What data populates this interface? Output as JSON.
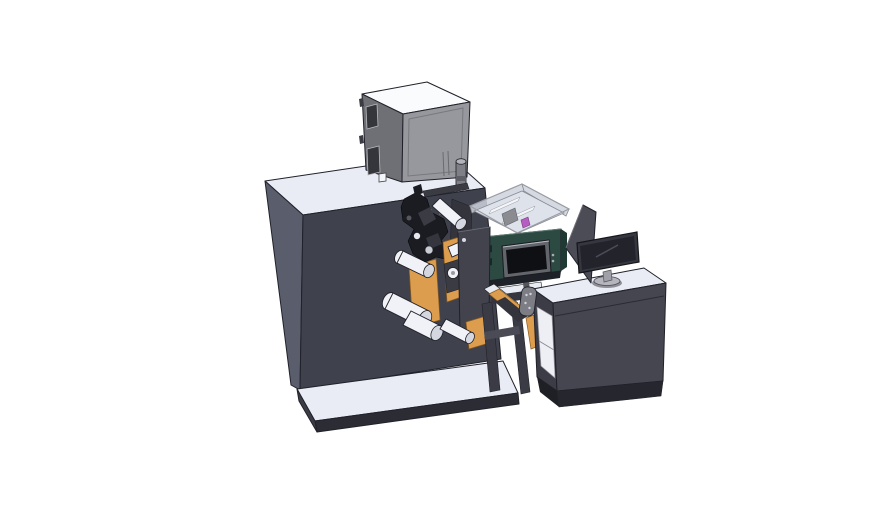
{
  "scene": {
    "type": "3d-cad-render",
    "background": "#ffffff",
    "components": [
      "machine-body",
      "electrical-cabinet",
      "printhead-cluster",
      "web-rollers",
      "media-plates",
      "mechanism-plate",
      "control-hmi-box",
      "transparent-enclosure",
      "hmi-screen",
      "output-chute",
      "sensor-unit",
      "support-legs",
      "base-platform",
      "operator-desk",
      "desk-shelf",
      "divider-panel",
      "monitor",
      "monitor-stand"
    ]
  },
  "palette": {
    "bg": "#ffffff",
    "outline": "#20212a",
    "machine-top": "#e9ecf5",
    "machine-left": "#5a5d6c",
    "machine-front": "#3f414d",
    "cabinet-top": "#fafbfd",
    "cabinet-left": "#6f7076",
    "cabinet-front": "#97989d",
    "cabinet-window": "#35363c",
    "cabinet-metal": "#b9bac0",
    "platform-top": "#e9ecf5",
    "platform-front": "#2b2c34",
    "platform-side": "#3b3c45",
    "roller": "#f1f2f7",
    "roller-end": "#d5d7e0",
    "black-part": "#1b1c22",
    "black-part-lt": "#3a3b43",
    "orange": "#dc9d4e",
    "orange-deep": "#8a5a1e",
    "plate": "#42434d",
    "backplate": "#33343c",
    "teal": "#2c4a42",
    "teal-left": "#234438",
    "teal-right": "#1e3a33",
    "teal-bottom": "#1f2128",
    "hmi-bezel": "#63656d",
    "hmi-screen": "#0f1014",
    "enclosure-wall": "rgba(206,211,221,0.85)",
    "enclosure-floor": "#dde2eb",
    "enclosure-edge": "#8a8b93",
    "bar-white": "#f4f5f9",
    "block-gray": "#8b8c92",
    "magenta": "#b65ec0",
    "magenta-stroke": "#7d3a86",
    "leg": "#3a3b44",
    "brace": "#4a4b55",
    "rail-white": "#e9ebf2",
    "rail-dark": "#35363e",
    "chute-dark": "#33343c",
    "sensor": "#7d7e85",
    "sensor-dot": "#d2d3d9",
    "desk-top": "#e9ecf5",
    "desk-front": "#45464f",
    "desk-left": "#3b3c45",
    "desk-plinth": "#26272e",
    "shelf-white": "#edeff5",
    "divider": "#4b4c56",
    "monitor-frame": "#35363f",
    "monitor-screen": "#23242b",
    "stand": "#9fa0a8",
    "stand-base": "#b4b5bd",
    "dot-light": "#a9aab2"
  }
}
